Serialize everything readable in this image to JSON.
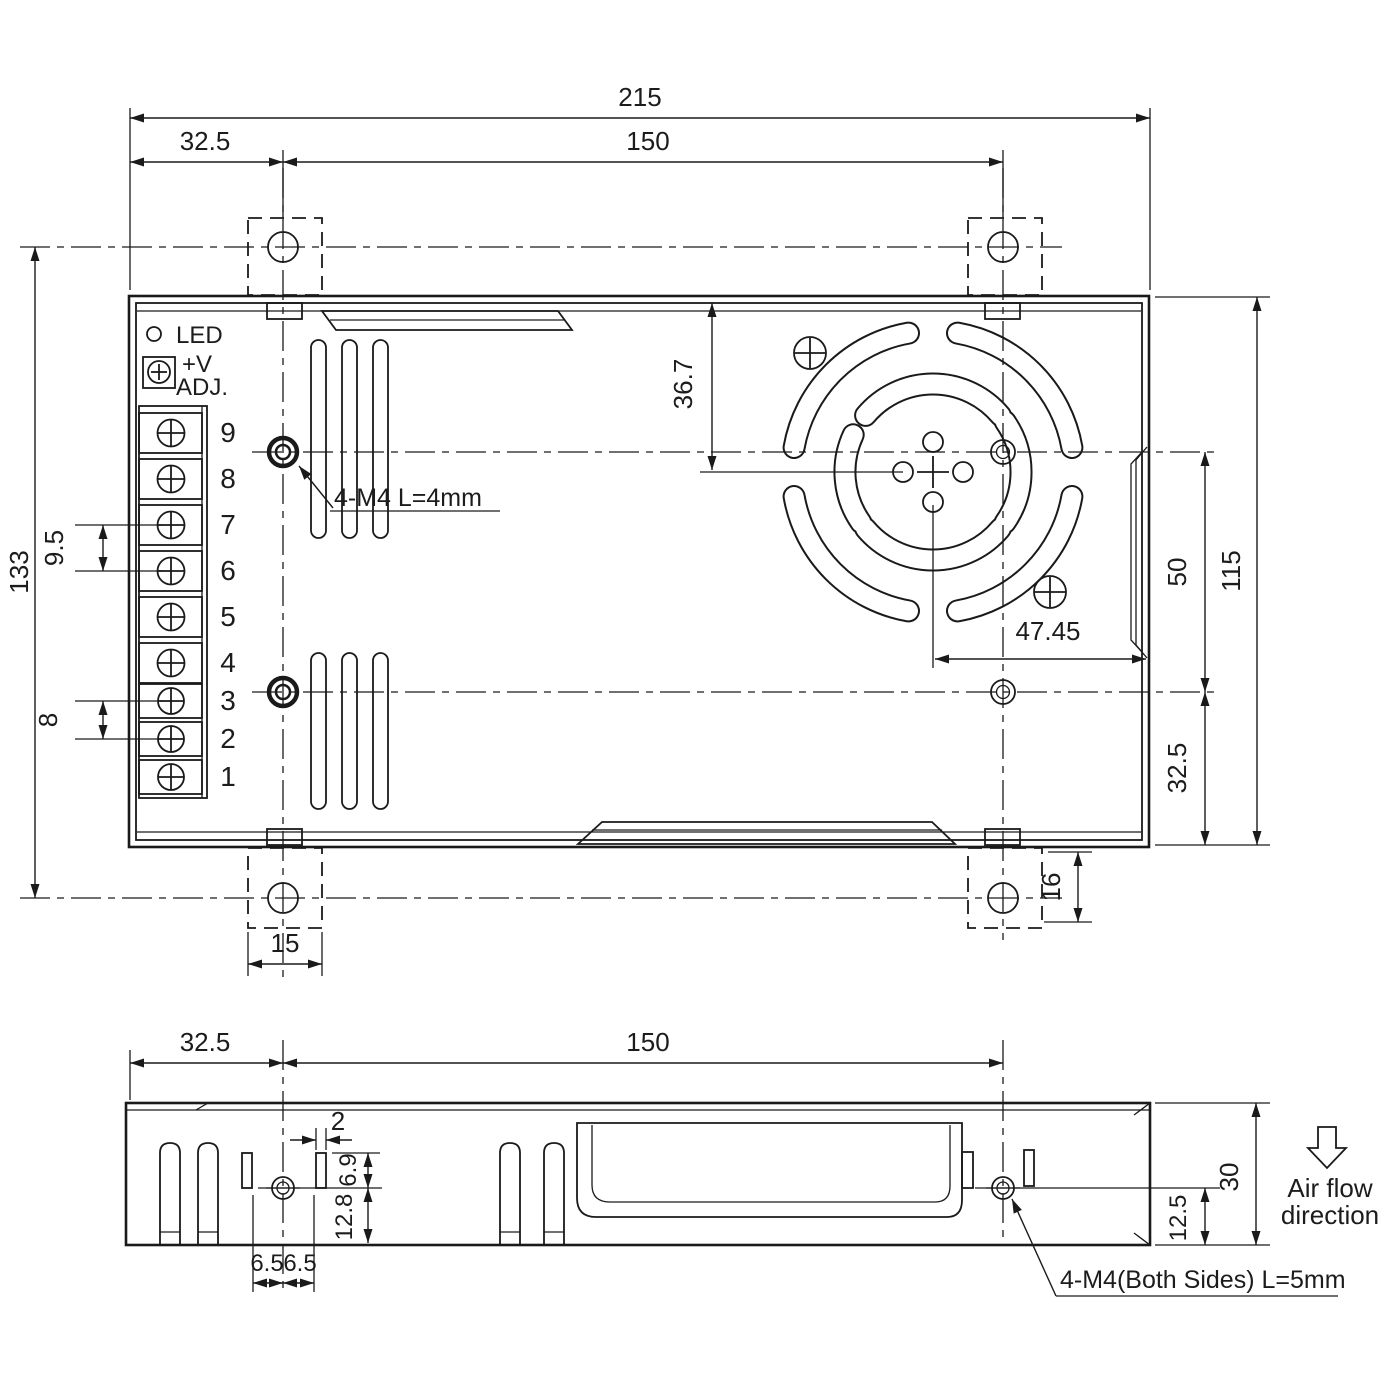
{
  "top_view": {
    "dim_total_width": "215",
    "dim_mount_offset": "32.5",
    "dim_mount_span": "150",
    "dim_total_height": "133",
    "dim_terminal_pitch_large": "9.5",
    "dim_terminal_pitch_small": "8",
    "dim_fan_center_from_top": "36.7",
    "dim_fan_center_to_edge": "47.45",
    "dim_hole_span": "50",
    "dim_case_width": "115",
    "dim_hole_to_bottom": "32.5",
    "dim_tab_width": "15",
    "dim_tab_length": "16",
    "label_led": "LED",
    "label_vadj_1": "+V",
    "label_vadj_2": "ADJ.",
    "label_mount_note": "4-M4 L=4mm",
    "terminals": [
      "9",
      "8",
      "7",
      "6",
      "5",
      "4",
      "3",
      "2",
      "1"
    ]
  },
  "side_view": {
    "dim_mount_offset": "32.5",
    "dim_mount_span": "150",
    "dim_slot_width": "2",
    "dim_slot_to_center": "6.9",
    "dim_center_to_bottom": "12.8",
    "dim_hole_offset_left": "6.5",
    "dim_hole_offset_right": "6.5",
    "dim_height": "30",
    "dim_hole_to_bottom": "12.5",
    "label_mount_note": "4-M4(Both Sides) L=5mm",
    "label_airflow_1": "Air flow",
    "label_airflow_2": "direction"
  }
}
